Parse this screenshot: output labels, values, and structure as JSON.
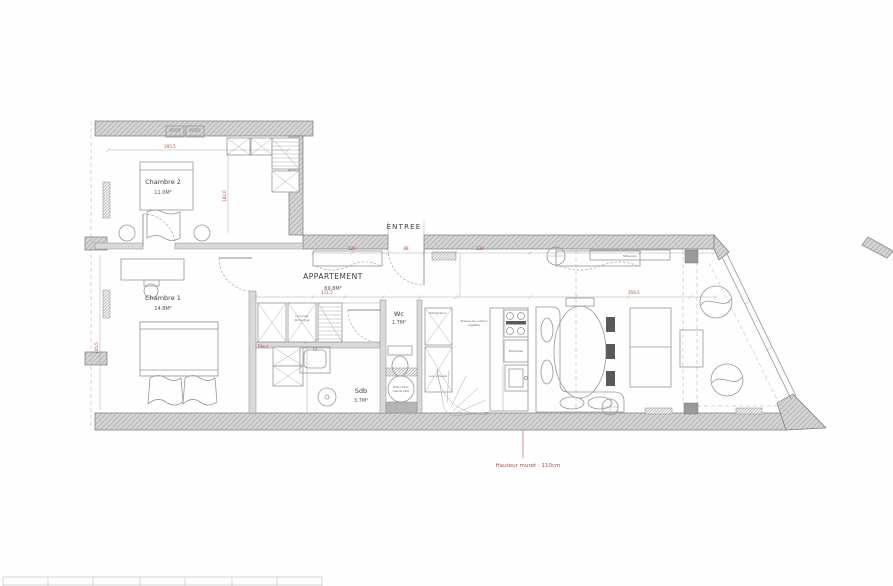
{
  "plan": {
    "title_hint": "Apartment floor plan",
    "rooms": {
      "chambre2": {
        "name": "Chambre 2",
        "area": "11.0M²"
      },
      "chambre1": {
        "name": "Chambre 1",
        "area": "14.8M²"
      },
      "appartement": {
        "name": "APPARTEMENT",
        "area": "69.8M²"
      },
      "entree": {
        "name": "ENTREE"
      },
      "wc": {
        "name": "Wc",
        "area": "1.7M²"
      },
      "sdb": {
        "name": "Sdb",
        "area": "3.7M²"
      }
    },
    "labels": {
      "fileur": "Fileur",
      "hauteur_muret": "Hauteur muret : 110cm",
      "lave_linge": "Lave linge",
      "seche_linge": "Sèche linge",
      "poubelles": "Poubelles",
      "plaque_cuisson_1": "Plaque de cuisson",
      "plaque_cuisson_2": "réglable",
      "ballon_1": "Ballon Eaux",
      "ballon_2": "chaude 200L",
      "lave_vaisselle": "Lave vaisselle",
      "refrigerateur": "Réfrigérateur",
      "television": "Télévision"
    },
    "dimensions": {
      "top_chambre2": "295.5",
      "side_chambre2": "182.0",
      "side_chambre1": "245.5",
      "hall_1": "120",
      "hall_2": "88",
      "hall_3": "133",
      "mid_1": "111.5",
      "mid_2": "456.5"
    },
    "colors": {
      "dimension_red": "#bb4a44",
      "wall_fill": "#d4d4d4",
      "wall_line": "#787878",
      "furniture_line": "#979797",
      "text_dark": "#4a4a4a"
    }
  }
}
